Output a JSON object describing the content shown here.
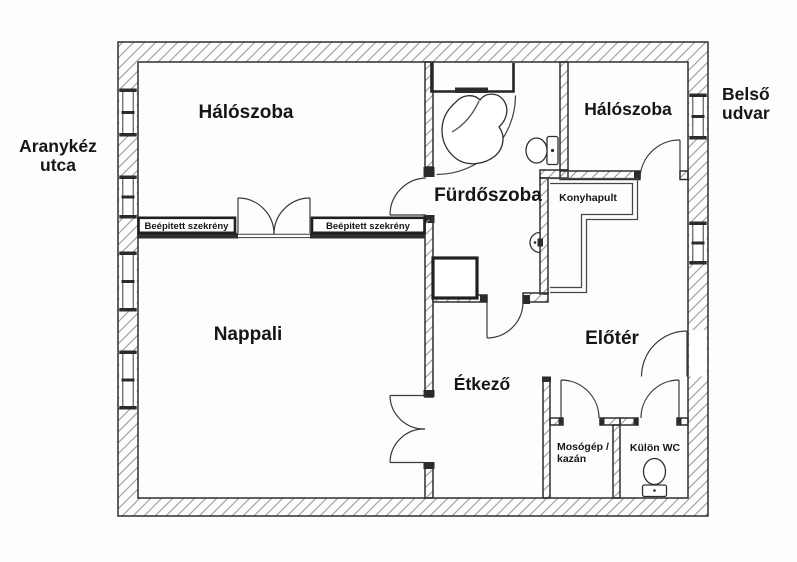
{
  "plan": {
    "street_label": {
      "line1": "Aranykéz",
      "line2": "utca"
    },
    "courtyard_label": {
      "line1": "Belső",
      "line2": "udvar"
    },
    "rooms": {
      "bedroom_left": "Hálószoba",
      "bedroom_right": "Hálószoba",
      "bathroom": "Fürdőszoba",
      "kitchen_counter": "Konyhapult",
      "living_room": "Nappali",
      "entry_hall": "Előtér",
      "dining_room": "Étkező",
      "utility_room": {
        "line1": "Mosógép /",
        "line2": "kazán"
      },
      "separate_wc": "Külön WC"
    },
    "wardrobes": [
      "Beépitett szekrény",
      "Beépitett szekrény"
    ]
  },
  "colors": {
    "line": "#2f2f2f",
    "hatch_line": "#9a9a9a",
    "paper": "#fdfdfd",
    "text": "#161616"
  }
}
